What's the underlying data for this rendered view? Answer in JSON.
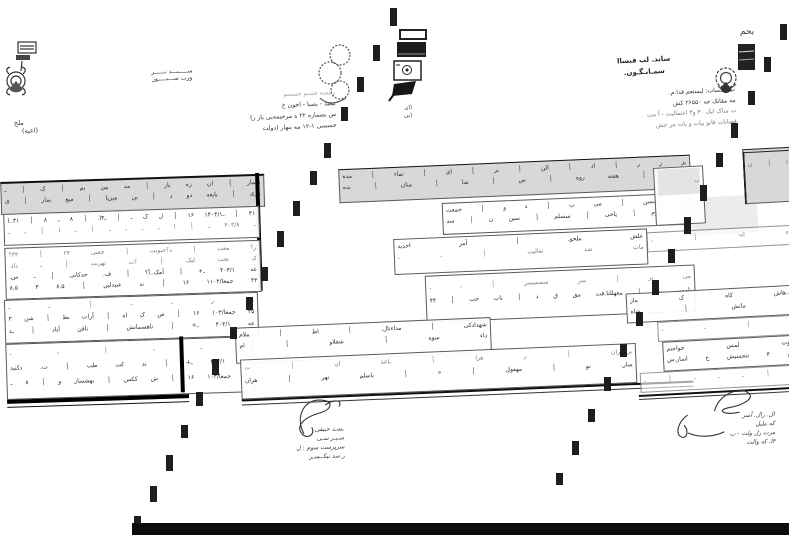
{
  "colors": {
    "ink": "#2e2e2e",
    "header_gray": "#d8d8d8",
    "paper": "#ffffff",
    "mark": "#1e1e1e"
  },
  "doc_left": {
    "title": [
      "ســـــٮـــد ٮــــــر",
      "ورٮ ســـٮـــــور"
    ],
    "side_note": [
      "ملح",
      "(اعیه)"
    ],
    "address": [
      "رئیسه حسنو حسسو",
      "ببعید - بصبا - اخون خ",
      "س بصماره ۲۲ ه مرحیمه‌بی بار ر)",
      "حسسی ۱-۱۲ مه بنهار (دولت"
    ],
    "table": {
      "header": [
        "شمار │ ان زه باز │ مد بین یم │ ک │ ـ",
        "بازی │ بایعه دو د │ بن میزیا │ میع بمار │ ی"
      ],
      "rows": {
        "r1": [
          "۴۱ │ ـ۱۴۰۳/۱ ۱۶ │ ل ک ـ │ ـ۳ا. │ ۸ ـ ۸ │ ۳۱..ا",
          "ـ ۴۰۳/۸ ـ │ ا ـ ـ ـ ـ │ ـ ا │ ـ ـ"
        ],
        "r2": [
          "ر؟ معت │ د؟حبوبت │ جعنی ٢٣ │ ٣٣؟",
          "ک تحت لبک │ ؟ت تهرنت │ ـ داد.",
          "عه ۴۰۳/۱ ـ+ │ آمک..آ؟ │ ف. حدکانی │ ـ س.",
          "۴۳ جمعا/۱۱۰۳ ۱۶ │ ند عبیدلیں │ ۸.۵ ۳ ۸.۵"
        ],
        "r3": [
          "ـ ر ـ ـ │ ـ ـ",
          "۴۵ جمعا/۱۰۳ ۱۶ │ ض ک اه │ آرات نظ │ شن ۳",
          "عه ۴۰۳/۱ ـ+ │ ناهسمانش │ ناقن آباد │ ـد"
        ],
        "r4": [
          "ـ ـ ـ │ ـ ـ",
          "عه ۴۰۳/۱ ـ+ │ ند کت طب │ ت. دکنید",
          "۴۷ جمعا/۱۰۳ ۱۶ │ ش ککس │ بهشساز و │ ۸ ـ"
        ]
      }
    },
    "signature_lines": [
      "ـسـد حبیقی",
      "سـبـر سـی",
      "سرپرست سوم : ل",
      "ر سد نیکــسـر"
    ]
  },
  "doc_middle": {
    "stamp_note": [
      "(ان",
      "(نی"
    ],
    "table": {
      "header": [
        "بز ر ر │ اد │ الن │ بر │ ای │ نماء │ مده",
        "روباریح │ هفته روه │ س │ شا │ متان │ نده"
      ],
      "rows": {
        "b1": [
          "وه رسسن │ می ب │ ء و │ حمعت",
          "پرر سوم │ پاحی │ سسلم │ سین ن │ سد"
        ],
        "b2": [
          "علش ملحو. │ آمر احدید",
          "ماتِ شد تعالیت │ ـ ـ"
        ],
        "b3": [
          "می بر │ سر سسمیسر │ ـ ـ",
          "ناممن بن │ معهللنا.فت مق ق د │ ناب حب │ ۴۴"
        ],
        "b4": [
          "شهدادکی │ مداءنال. │ اط │ ملام",
          "داء سوه │ شقلاو │ ام"
        ],
        "b5": [
          "برامیران │ ر هزا │ باعة ان │ ت",
          "سار. تو │ مهفول │ « │ باسلم تهر │ هران"
        ]
      }
    }
  },
  "doc_right": {
    "logo_script": "بحم",
    "title": [
      "ساند. لب فبساا",
      "سمـاٮـگـون."
    ],
    "address": [
      "ب ناحساب: لیستعم فدا.م.",
      "مه مقاتک حه ۲۶۵۵۰ کش",
      "ب مناک ایک ۳۰ و۳ اعتمالیت - آ مت",
      "قصابات فانو بیات و بات مر حش"
    ],
    "table": {
      "corner_cells": "ا │ ن",
      "box_cells": "ٮ",
      "rows": {
        "c1": "ء اه- │ ـ",
        "c2": [
          "د.هاش کاه ک ماز",
          "ـ مانش │ شاه"
        ],
        "c3": "ـ │ ـ ـ",
        "c4": [
          "ادوت لمس خواجنم",
          "ش ۴ تنحسیش ح اسار.س"
        ],
        "c5": "ـ │ ـ ـ ـ │ ـ"
      }
    },
    "signature_lines": [
      "ال. رال. آسر",
      "که ملبل",
      "مرت رل ولت - ب",
      "۳ا، که والت"
    ]
  },
  "artifacts": {
    "marks_series1": [
      [
        390,
        8,
        18
      ],
      [
        373,
        45,
        16
      ],
      [
        357,
        77,
        15
      ],
      [
        341,
        107,
        14
      ],
      [
        324,
        143,
        15
      ],
      [
        310,
        171,
        14
      ],
      [
        293,
        201,
        15
      ],
      [
        277,
        231,
        16
      ],
      [
        261,
        267,
        14
      ],
      [
        246,
        297,
        13
      ],
      [
        230,
        327,
        12
      ],
      [
        212,
        359,
        16
      ],
      [
        196,
        392,
        14
      ],
      [
        181,
        425,
        13
      ],
      [
        166,
        455,
        16
      ],
      [
        150,
        486,
        16
      ],
      [
        134,
        516,
        9
      ]
    ],
    "marks_series2": [
      [
        780,
        24,
        16
      ],
      [
        764,
        57,
        15
      ],
      [
        748,
        91,
        14
      ],
      [
        731,
        123,
        15
      ],
      [
        716,
        153,
        14
      ],
      [
        700,
        185,
        16
      ],
      [
        684,
        217,
        17
      ],
      [
        668,
        249,
        14
      ],
      [
        652,
        280,
        15
      ],
      [
        636,
        312,
        14
      ],
      [
        620,
        344,
        13
      ],
      [
        604,
        377,
        14
      ],
      [
        588,
        409,
        13
      ],
      [
        572,
        441,
        14
      ],
      [
        556,
        473,
        12
      ]
    ]
  }
}
